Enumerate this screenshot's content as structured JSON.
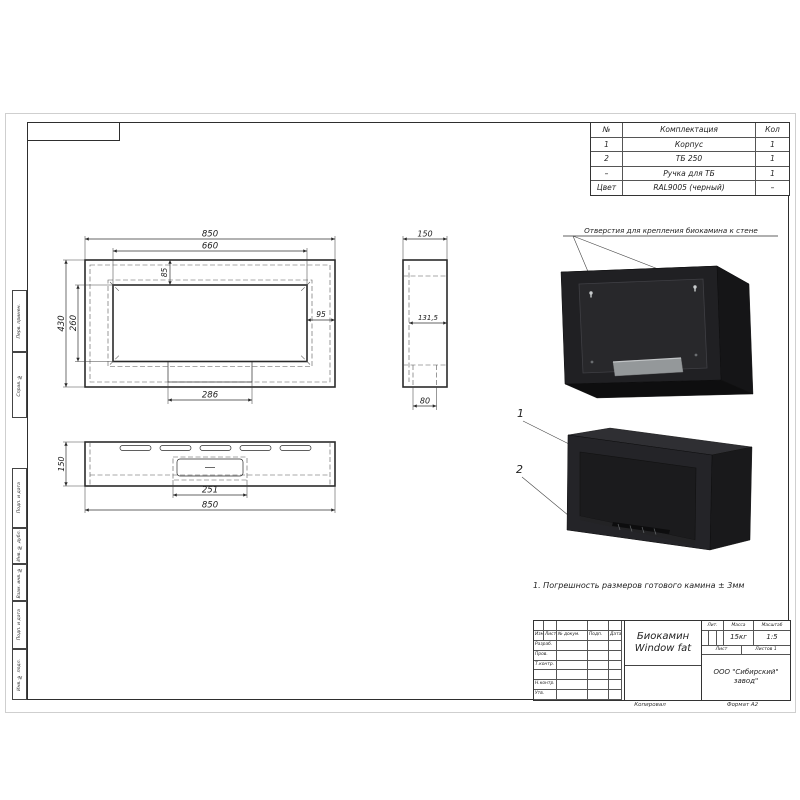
{
  "sheet": {
    "copy_label": "Копировал",
    "format": "Формат  А2"
  },
  "parts_table": {
    "col_no": "№",
    "col_name": "Комплектация",
    "col_qty": "Кол",
    "rows": [
      {
        "no": "1",
        "name": "Корпус",
        "qty": "1"
      },
      {
        "no": "2",
        "name": "ТБ 250",
        "qty": "1"
      },
      {
        "no": "–",
        "name": "Ручка для ТБ",
        "qty": "1"
      },
      {
        "no": "Цвет",
        "name": "RAL9005 (черный)",
        "qty": "–"
      }
    ]
  },
  "annotations": {
    "mounting": "Отверстия для крепления биокамина к стене",
    "note": "1. Погрешность размеров готового камина ± 3мм",
    "callout1": "1",
    "callout2": "2"
  },
  "dims": {
    "front": {
      "width": "850",
      "opening_width": "660",
      "height": "430",
      "opening_height": "260",
      "top_offset": "85",
      "side_offset": "95",
      "burner_width": "286"
    },
    "side": {
      "depth": "150",
      "inner_depth": "131,5",
      "slot": "80"
    },
    "top": {
      "depth": "150",
      "burner": "251",
      "width": "850"
    }
  },
  "margin_labels": [
    "Перв. примен.",
    "Справ. №",
    "Подп. и дата",
    "Инв. № дубл.",
    "Взам. инв. №",
    "Подп. и дата",
    "Инв. № подл."
  ],
  "title_block": {
    "name_line1": "Биокамин",
    "name_line2": "Window fat",
    "col_izm": "Изм.",
    "col_list": "Лист",
    "col_doc": "№ докум.",
    "col_podp": "Подп.",
    "col_data": "Дата",
    "row_razrab": "Разраб.",
    "row_prov": "Пров.",
    "row_tkontr": "Т.контр.",
    "row_nkontr": "Н.контр.",
    "row_utv": "Утв.",
    "lit": "Лит.",
    "mass": "Масса",
    "scale": "Масштаб",
    "mass_value": "15кг",
    "scale_value": "1:5",
    "sheet_label": "Лист",
    "sheets_label": "Листов",
    "sheets_value": "1",
    "company_line1": "ООО \"Сибирский\"",
    "company_line2": "завод\""
  },
  "colors": {
    "body": "#242428",
    "body_top": "#2e2e31",
    "body_side": "#19191b",
    "panel": "#28282b",
    "burner_metal": "#94989a",
    "accent_line": "#2b2b2b"
  }
}
